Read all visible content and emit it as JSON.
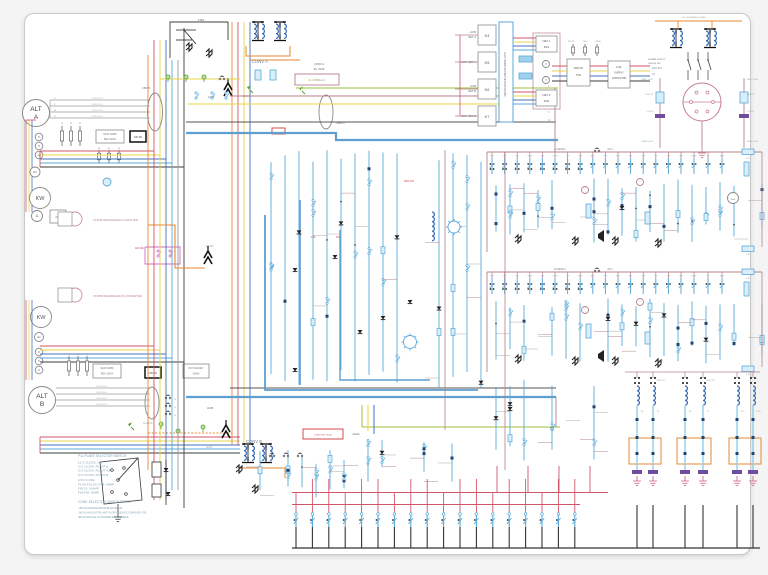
{
  "palette": {
    "red": "#d25468",
    "maroon": "#b5808e",
    "yellow": "#e7d44b",
    "blue": "#4472bc",
    "cyan": "#59a9d8",
    "ltblue": "#8fd0ea",
    "thickblue": "#5e9fd0",
    "orange": "#e48a33",
    "green": "#9cc23c",
    "dkgreen": "#55a030",
    "magenta": "#cf6fc9",
    "purple": "#6f4d9e",
    "black": "#3c3c3c",
    "gray": "#9a9a9a",
    "label": "#7c93a8",
    "redtext": "#d23a3a",
    "legend": "#7fa0b2"
  },
  "alt_a": {
    "l1": "ALT",
    "l2": "A",
    "phases": [
      "U",
      "V",
      "W",
      "N"
    ],
    "wire_ids": [
      "1205.01.01",
      "1205.02.01",
      "1205.03.01",
      "1205.04.01"
    ]
  },
  "alt_b": {
    "l1": "ALT",
    "l2": "B",
    "wire_ids": [
      "1206.01.01",
      "1206.02.01",
      "1206.03.01",
      "1206.04.01"
    ]
  },
  "meters": {
    "kw": "KW",
    "v": "V",
    "hz": "Hz",
    "a": "A",
    "avr": "AVR"
  },
  "plant_a": {
    "counter": "UTM/B FREQ/REGEN A COUNTER",
    "reg1": "MAIN SWBD",
    "reg2": "REG 200VA",
    "dc": "24V DC",
    "fuses": [
      "F1",
      "F2",
      "F3"
    ],
    "fuses2": [
      "F4",
      "F5",
      "F6"
    ],
    "acb": "ACB",
    "cbct": "CBCT1",
    "mc": "4A1 MC",
    "e3": "E3-MC"
  },
  "plant_b": {
    "counter": "UTM/B FREQ/REGEN B CONVERTER",
    "reg1": "MAIN SWBD",
    "reg2": "REG 200VA",
    "dc": "24V DC",
    "bat1": "BAT MAGNET",
    "bat2": "SWBD",
    "alcb": "ALCBC9",
    "acb": "ACB",
    "taps": [
      "40",
      "41",
      "42"
    ]
  },
  "conv_a": {
    "name": "CONV A",
    "sub": "13A2",
    "b1": "CONV A",
    "b2": "B+ S245",
    "kl1": "KL1 MMB+A-C",
    "s2": "S2-K4",
    "cbcp": "CBCP1",
    "amt": "AMT ON",
    "f05": "F05",
    "f06": "F06"
  },
  "conv_b": {
    "name": "CONV B",
    "s2": "S2-K6",
    "box": "CONV B B+ S242",
    "plus": "+S242"
  },
  "bus_nums": [
    "4",
    "8",
    "7",
    "9",
    "16"
  ],
  "acb_sets": {
    "a1": "ACB",
    "a2": "SET A",
    "k4": "K4",
    "nwpa": "NWP SET A",
    "k5": "K5",
    "b1": "ACB",
    "b2": "SET B",
    "k6": "K6",
    "nwpb": "NWP SET B",
    "k7": "K7",
    "decoupling": "DECOUPLING MEASURING SYS."
  },
  "net": {
    "n1a": "NET 1",
    "n1b": "KD1",
    "n2a": "NET 2",
    "n2b": "KD2",
    "v": "V"
  },
  "supply": {
    "t1": "50KVA",
    "t2": "TSF",
    "k1": "K44",
    "k2": "SUPPLY",
    "k3": "CONTACTOR",
    "f12": "12 F12",
    "f13": "2 F13",
    "e13": "E13 A",
    "out1": "220V 61V",
    "out2": "AT"
  },
  "psu": {
    "main": "AC 100V(MAIN) SQ.MA1",
    "sw1": "POWER SUPPLY",
    "sw2": "ON/OFF SW",
    "la": [
      "MMB+ 12-A1",
      "S206.18",
      "2-1K02",
      "MMB- 0-K02"
    ],
    "ra": [
      "MB2+ 12-B1",
      "S206.07",
      "2-1K04",
      "MMB- 0-K04"
    ]
  },
  "band_a": {
    "reset": "A RESET",
    "tag": "1211",
    "f": "F11",
    "fb": "F10",
    "tm": "Tm2",
    "contacts": [
      "ICHT",
      "LOP",
      "VAL",
      "OVER",
      "OVS",
      "SCCB",
      "LOP",
      "UCB",
      "ACB",
      "EUS",
      "EVU",
      "VEL",
      "UVB",
      "TW",
      "CW",
      "UVR",
      "H-OFF",
      "UB",
      "HIGH"
    ]
  },
  "band_b": {
    "reset": "B RESET",
    "tag": "2011",
    "f": "F19",
    "fb": "F18",
    "contacts": [
      "ICHT",
      "LOP",
      "VAL",
      "OVER",
      "OVS",
      "SCCB",
      "LOP",
      "ACB",
      "ACB",
      "EUS",
      "BLR",
      "ASL",
      "UVB",
      "TW",
      "CW",
      "UVR",
      "H-OFF",
      "UB",
      "HIGH"
    ]
  },
  "chains": {
    "labels": [
      "K4",
      "K5",
      "K6",
      "K7",
      "KD1",
      "KD2"
    ],
    "off": "NWP OFF"
  },
  "legend": {
    "lines": [
      "P1L PLANT SELECTOR SWITCH",
      "12 O CLOCK: OFF",
      "3 O CLOCK: PLANT A",
      "6 O CLOCK: PLANT A/B",
      "9 O CLOCK: PLANT B",
      "A B C FUSE",
      "F1-F8,F10,F12-F16: 4AMP",
      "F9,F11: 10AMP",
      "F16-F20: 6AMP"
    ]
  },
  "conv_panel": {
    "lines": [
      "CONV. SELECTOR SWITCH PANEL",
      "-45:00 ANGLE ENGINE ENABLE",
      "-90:00 ANGLE PLANT A OR B BUS COUPLER ON",
      "45:00 ANGLE CONVERTER ENABLE"
    ]
  }
}
